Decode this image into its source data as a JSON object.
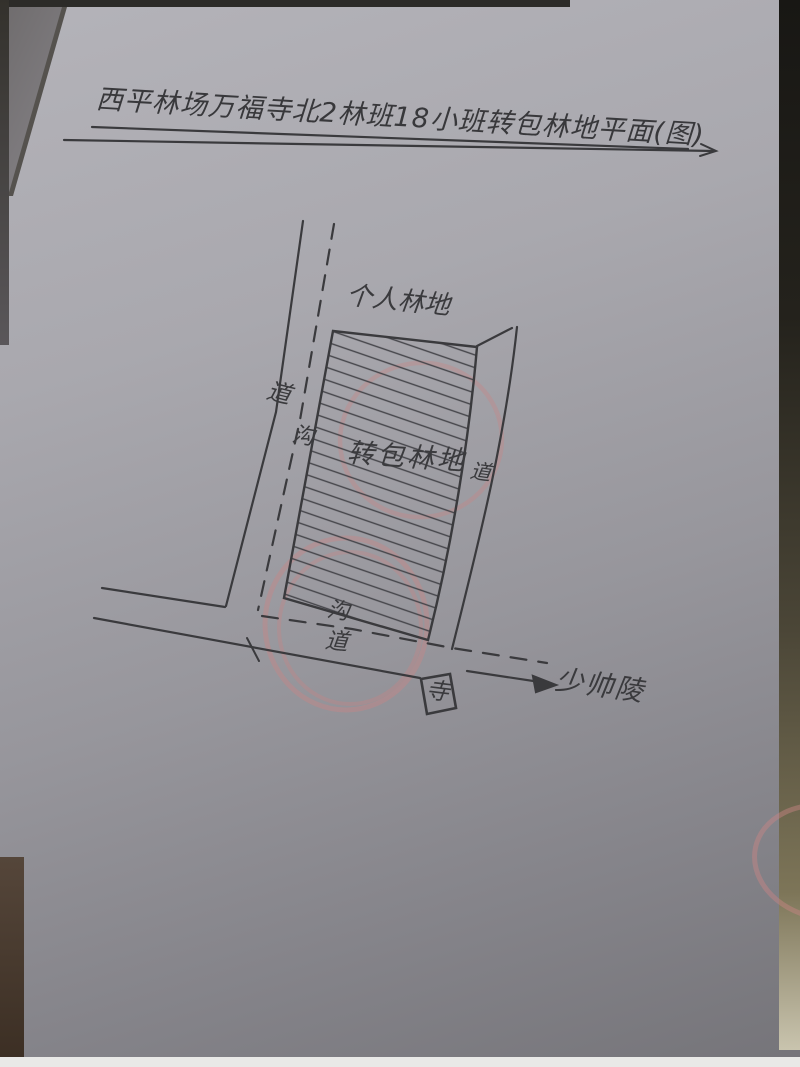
{
  "document": {
    "kind": "hand-drawn forest land plan sketch on paper (photo)",
    "title": "西平林场万福寺北2林班18小班转包林地平面(图)"
  },
  "map": {
    "labels": {
      "personal_forest": "个人林地",
      "subcontract_forest": "转包林地",
      "left_road_dao": "道",
      "left_road_gou": "沟",
      "right_road_dao": "道",
      "bottom_road_gou": "沟",
      "bottom_road_dao": "道",
      "temple": "寺",
      "destination": "少帅陵"
    },
    "features": {
      "parcel": "hatched polygon marking the subcontracted forest land",
      "roads": "dashed-and-solid road along left side, curved road on right, road along bottom with arrow pointing to 少帅陵",
      "temple_box": "small rectangle labeled 寺 below the bottom road",
      "red_marks": "faint red pencil circles over the parcel and road junction, partial red circle at right edge"
    },
    "colors": {
      "ink": "#3a3a3d",
      "red_mark": "#c98585",
      "paper": "#a7a6ac"
    }
  }
}
